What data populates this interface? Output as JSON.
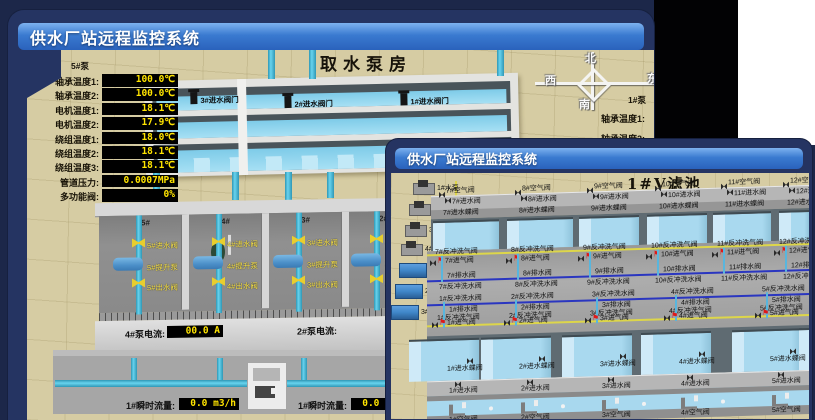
{
  "colors": {
    "accent_blue": "#3a7ad0",
    "desktop_navy": "#1c2749",
    "value_text_yellow": "#ffe400",
    "value_bg_black": "#000000",
    "alarm_red": "#e01818",
    "pipe_cyan": "#49c0e0",
    "valve_yellow": "#e8ce2e",
    "scene_tan": "#d6cca3"
  },
  "back_window": {
    "title": "供水厂站远程监控系统",
    "scene_title": "取水泵房",
    "pump_panel": {
      "pump_label": "5#泵",
      "rows": [
        {
          "label": "轴承温度1:",
          "value": "100.0℃"
        },
        {
          "label": "轴承温度2:",
          "value": "100.0℃"
        },
        {
          "label": "电机温度1:",
          "value": "18.1℃"
        },
        {
          "label": "电机温度2:",
          "value": "17.9℃"
        },
        {
          "label": "绕组温度1:",
          "value": "18.0℃"
        },
        {
          "label": "绕组温度2:",
          "value": "18.1℃"
        },
        {
          "label": "绕组温度3:",
          "value": "18.1℃"
        },
        {
          "label": "管道压力:",
          "value": "0.0007MPa"
        },
        {
          "label": "多功能阀:",
          "value": "0%"
        }
      ]
    },
    "intake_gates": [
      {
        "label": "3#进水阀门"
      },
      {
        "label": "2#进水阀门"
      },
      {
        "label": "1#进水阀门"
      }
    ],
    "compass": {
      "north": "北",
      "south": "南",
      "west": "西",
      "east": "东"
    },
    "right_partial": {
      "pump": "1#泵",
      "labels": [
        "轴承温度1:",
        "轴承温度2:"
      ]
    },
    "pump_bays": [
      {
        "bay": "5#",
        "inlet": "5#进水阀",
        "pump": "5#提升泵",
        "outlet": "5#出水阀"
      },
      {
        "bay": "4#",
        "inlet": "4#进水阀",
        "pump": "4#提升泵",
        "outlet": "4#出水阀"
      },
      {
        "bay": "3#",
        "inlet": "3#进水阀",
        "pump": "3#提升泵",
        "outlet": "3#出水阀"
      },
      {
        "bay": "2#",
        "inlet": "2#进水阀",
        "pump": "2#提升泵",
        "outlet": "2#出水阀"
      }
    ],
    "current_meters": [
      {
        "label": "4#泵电流:",
        "value": "00.0 A"
      },
      {
        "label": "2#泵电流:",
        "value": ""
      }
    ],
    "flow_meters": [
      {
        "label": "1#瞬时流量:",
        "value": "0.0 m3/h"
      },
      {
        "label": "1#瞬时流量:",
        "value": "0.0 m3/h"
      }
    ]
  },
  "front_window": {
    "title": "供水厂站远程监控系统",
    "scene_title": "1#V滤池",
    "pumps": [
      "1#水泵",
      "2#水泵",
      "3#水泵",
      "4#水泵"
    ],
    "fans": [
      "1#风机",
      "2#风机",
      "3#风机"
    ],
    "filter_cells_top": [
      {
        "air": "7#空气阀",
        "inlet": "7#进水阀",
        "butterfly": "7#进水蝶阀",
        "backwash_air": "7#反冲洗气阀",
        "air_inlet": "7#进气阀",
        "drain": "7#排水阀",
        "backwash_water": "7#反冲洗水阀"
      },
      {
        "air": "8#空气阀",
        "inlet": "8#进水阀",
        "butterfly": "8#进水蝶阀",
        "backwash_air": "8#反冲洗气阀",
        "air_inlet": "8#进气阀",
        "drain": "8#排水阀",
        "backwash_water": "8#反冲洗水阀"
      },
      {
        "air": "9#空气阀",
        "inlet": "9#进水阀",
        "butterfly": "9#进水蝶阀",
        "backwash_air": "9#反冲洗气阀",
        "air_inlet": "9#进气阀",
        "drain": "9#排水阀",
        "backwash_water": "9#反冲洗水阀"
      },
      {
        "air": "10#空气阀",
        "inlet": "10#进水阀",
        "butterfly": "10#进水蝶阀",
        "backwash_air": "10#反冲洗气阀",
        "air_inlet": "10#进气阀",
        "drain": "10#排水阀",
        "backwash_water": "10#反冲洗水阀"
      },
      {
        "air": "11#空气阀",
        "inlet": "11#进水阀",
        "butterfly": "11#进水蝶阀",
        "backwash_air": "11#反冲洗气阀",
        "air_inlet": "11#进气阀",
        "drain": "11#排水阀",
        "backwash_water": "11#反冲洗水阀"
      },
      {
        "air": "12#空气阀",
        "inlet": "12#进水阀",
        "butterfly": "12#进水蝶阀",
        "backwash_air": "12#反冲洗气阀",
        "air_inlet": "12#进气阀",
        "drain": "12#排水阀",
        "backwash_water": "12#反冲洗水阀"
      }
    ],
    "filter_cells_bottom": [
      {
        "air": "1#空气阀",
        "inlet": "1#进水阀",
        "butterfly": "1#进水蝶阀",
        "backwash_air": "1#反冲洗气阀",
        "air_inlet": "1#进气阀",
        "drain": "1#排水阀",
        "backwash_water": "1#反冲洗水阀"
      },
      {
        "air": "2#空气阀",
        "inlet": "2#进水阀",
        "butterfly": "2#进水蝶阀",
        "backwash_air": "2#反冲洗气阀",
        "air_inlet": "2#进气阀",
        "drain": "2#排水阀",
        "backwash_water": "2#反冲洗水阀"
      },
      {
        "air": "3#空气阀",
        "inlet": "3#进水阀",
        "butterfly": "3#进水蝶阀",
        "backwash_air": "3#反冲洗气阀",
        "air_inlet": "3#进气阀",
        "drain": "3#排水阀",
        "backwash_water": "3#反冲洗水阀"
      },
      {
        "air": "4#空气阀",
        "inlet": "4#进水阀",
        "butterfly": "4#进水蝶阀",
        "backwash_air": "4#反冲洗气阀",
        "air_inlet": "4#进气阀",
        "drain": "4#排水阀",
        "backwash_water": "4#反冲洗水阀"
      },
      {
        "air": "5#空气阀",
        "inlet": "5#进水阀",
        "butterfly": "5#进水蝶阀",
        "backwash_air": "5#反冲洗气阀",
        "air_inlet": "5#进气阀",
        "drain": "5#排水阀",
        "backwash_water": "5#反冲洗水阀"
      }
    ]
  }
}
